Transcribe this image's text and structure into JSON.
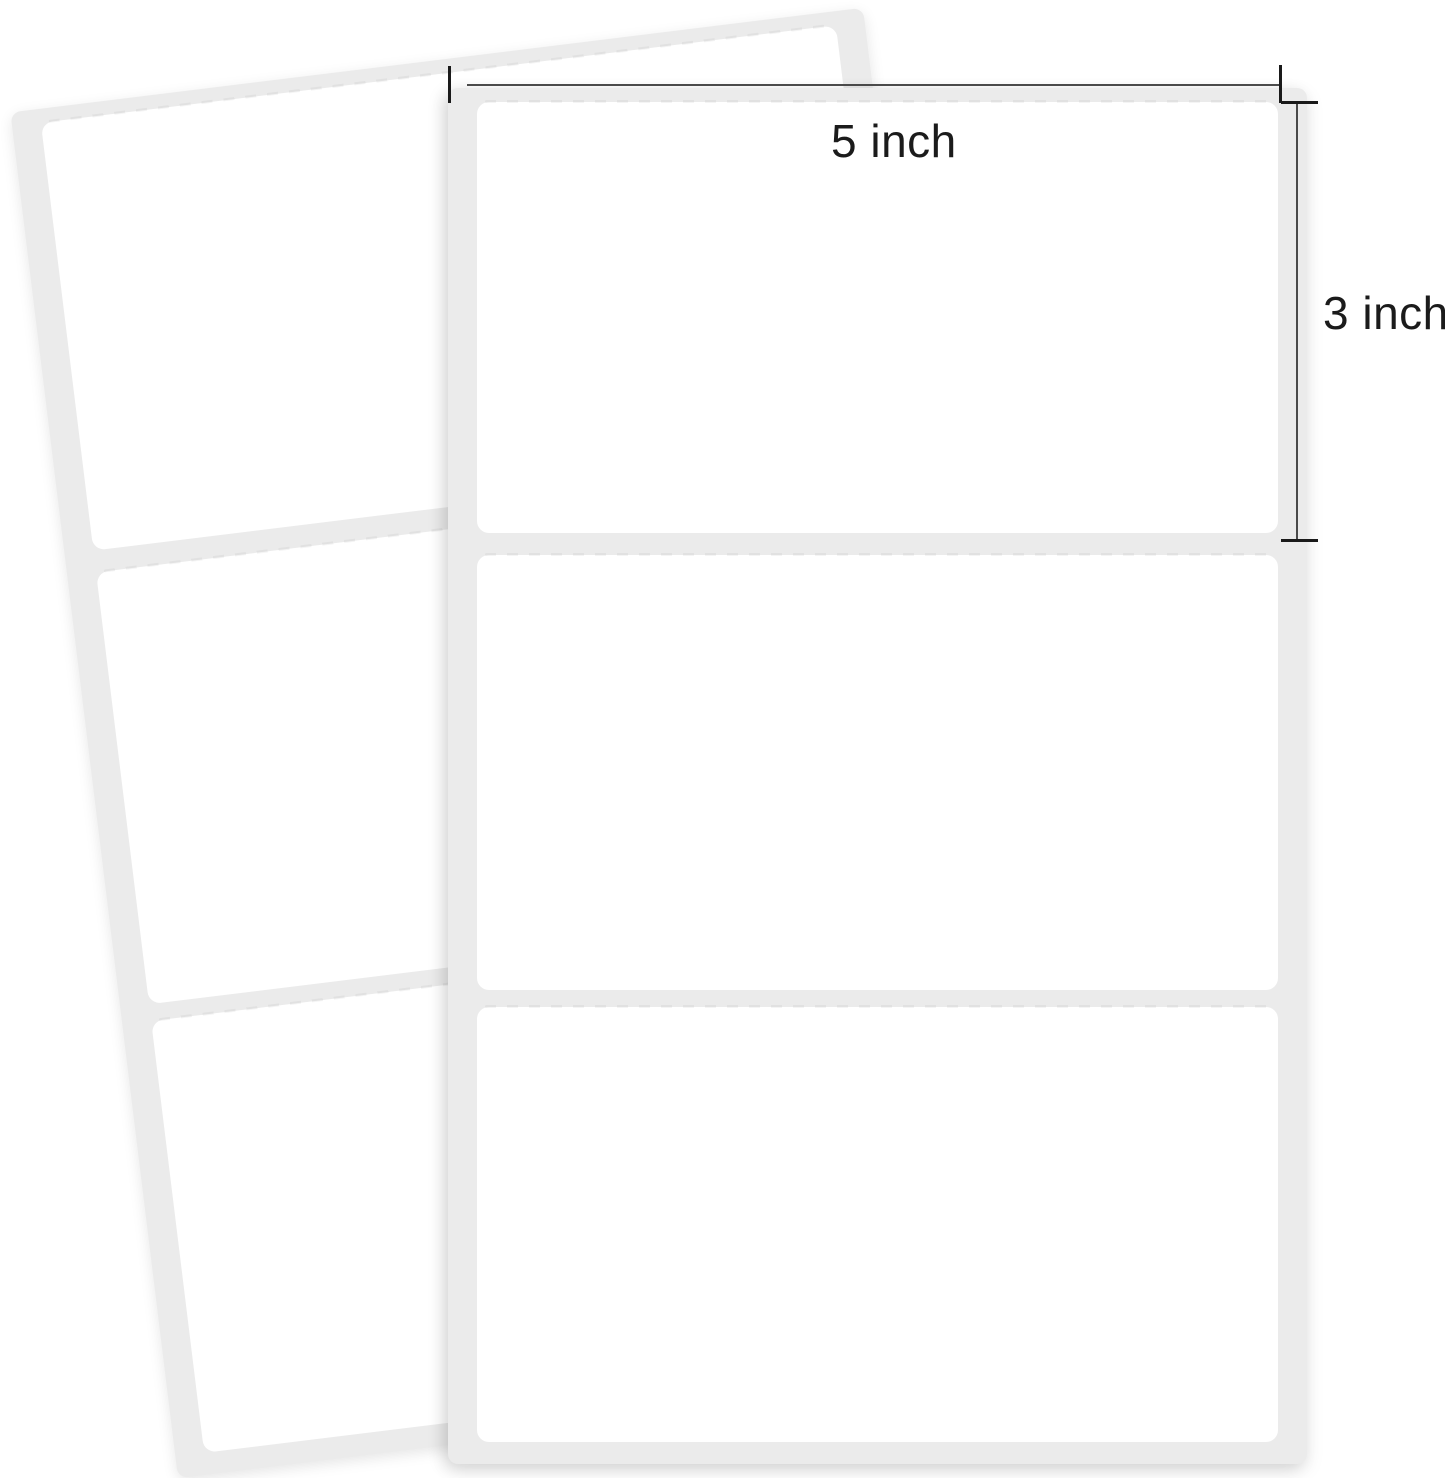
{
  "annotations": {
    "width_label": "5 inch",
    "height_label": "3 inch"
  },
  "sheets": {
    "front": {
      "labels_count": 3
    },
    "back": {
      "labels_count": 3
    }
  },
  "colors": {
    "background": "#ffffff",
    "sheet": "#ebebeb",
    "label": "#ffffff",
    "measure-line": "#4a4a4a",
    "measure-tick": "#1a1a1a",
    "annotation-text": "#1b1b1b"
  }
}
